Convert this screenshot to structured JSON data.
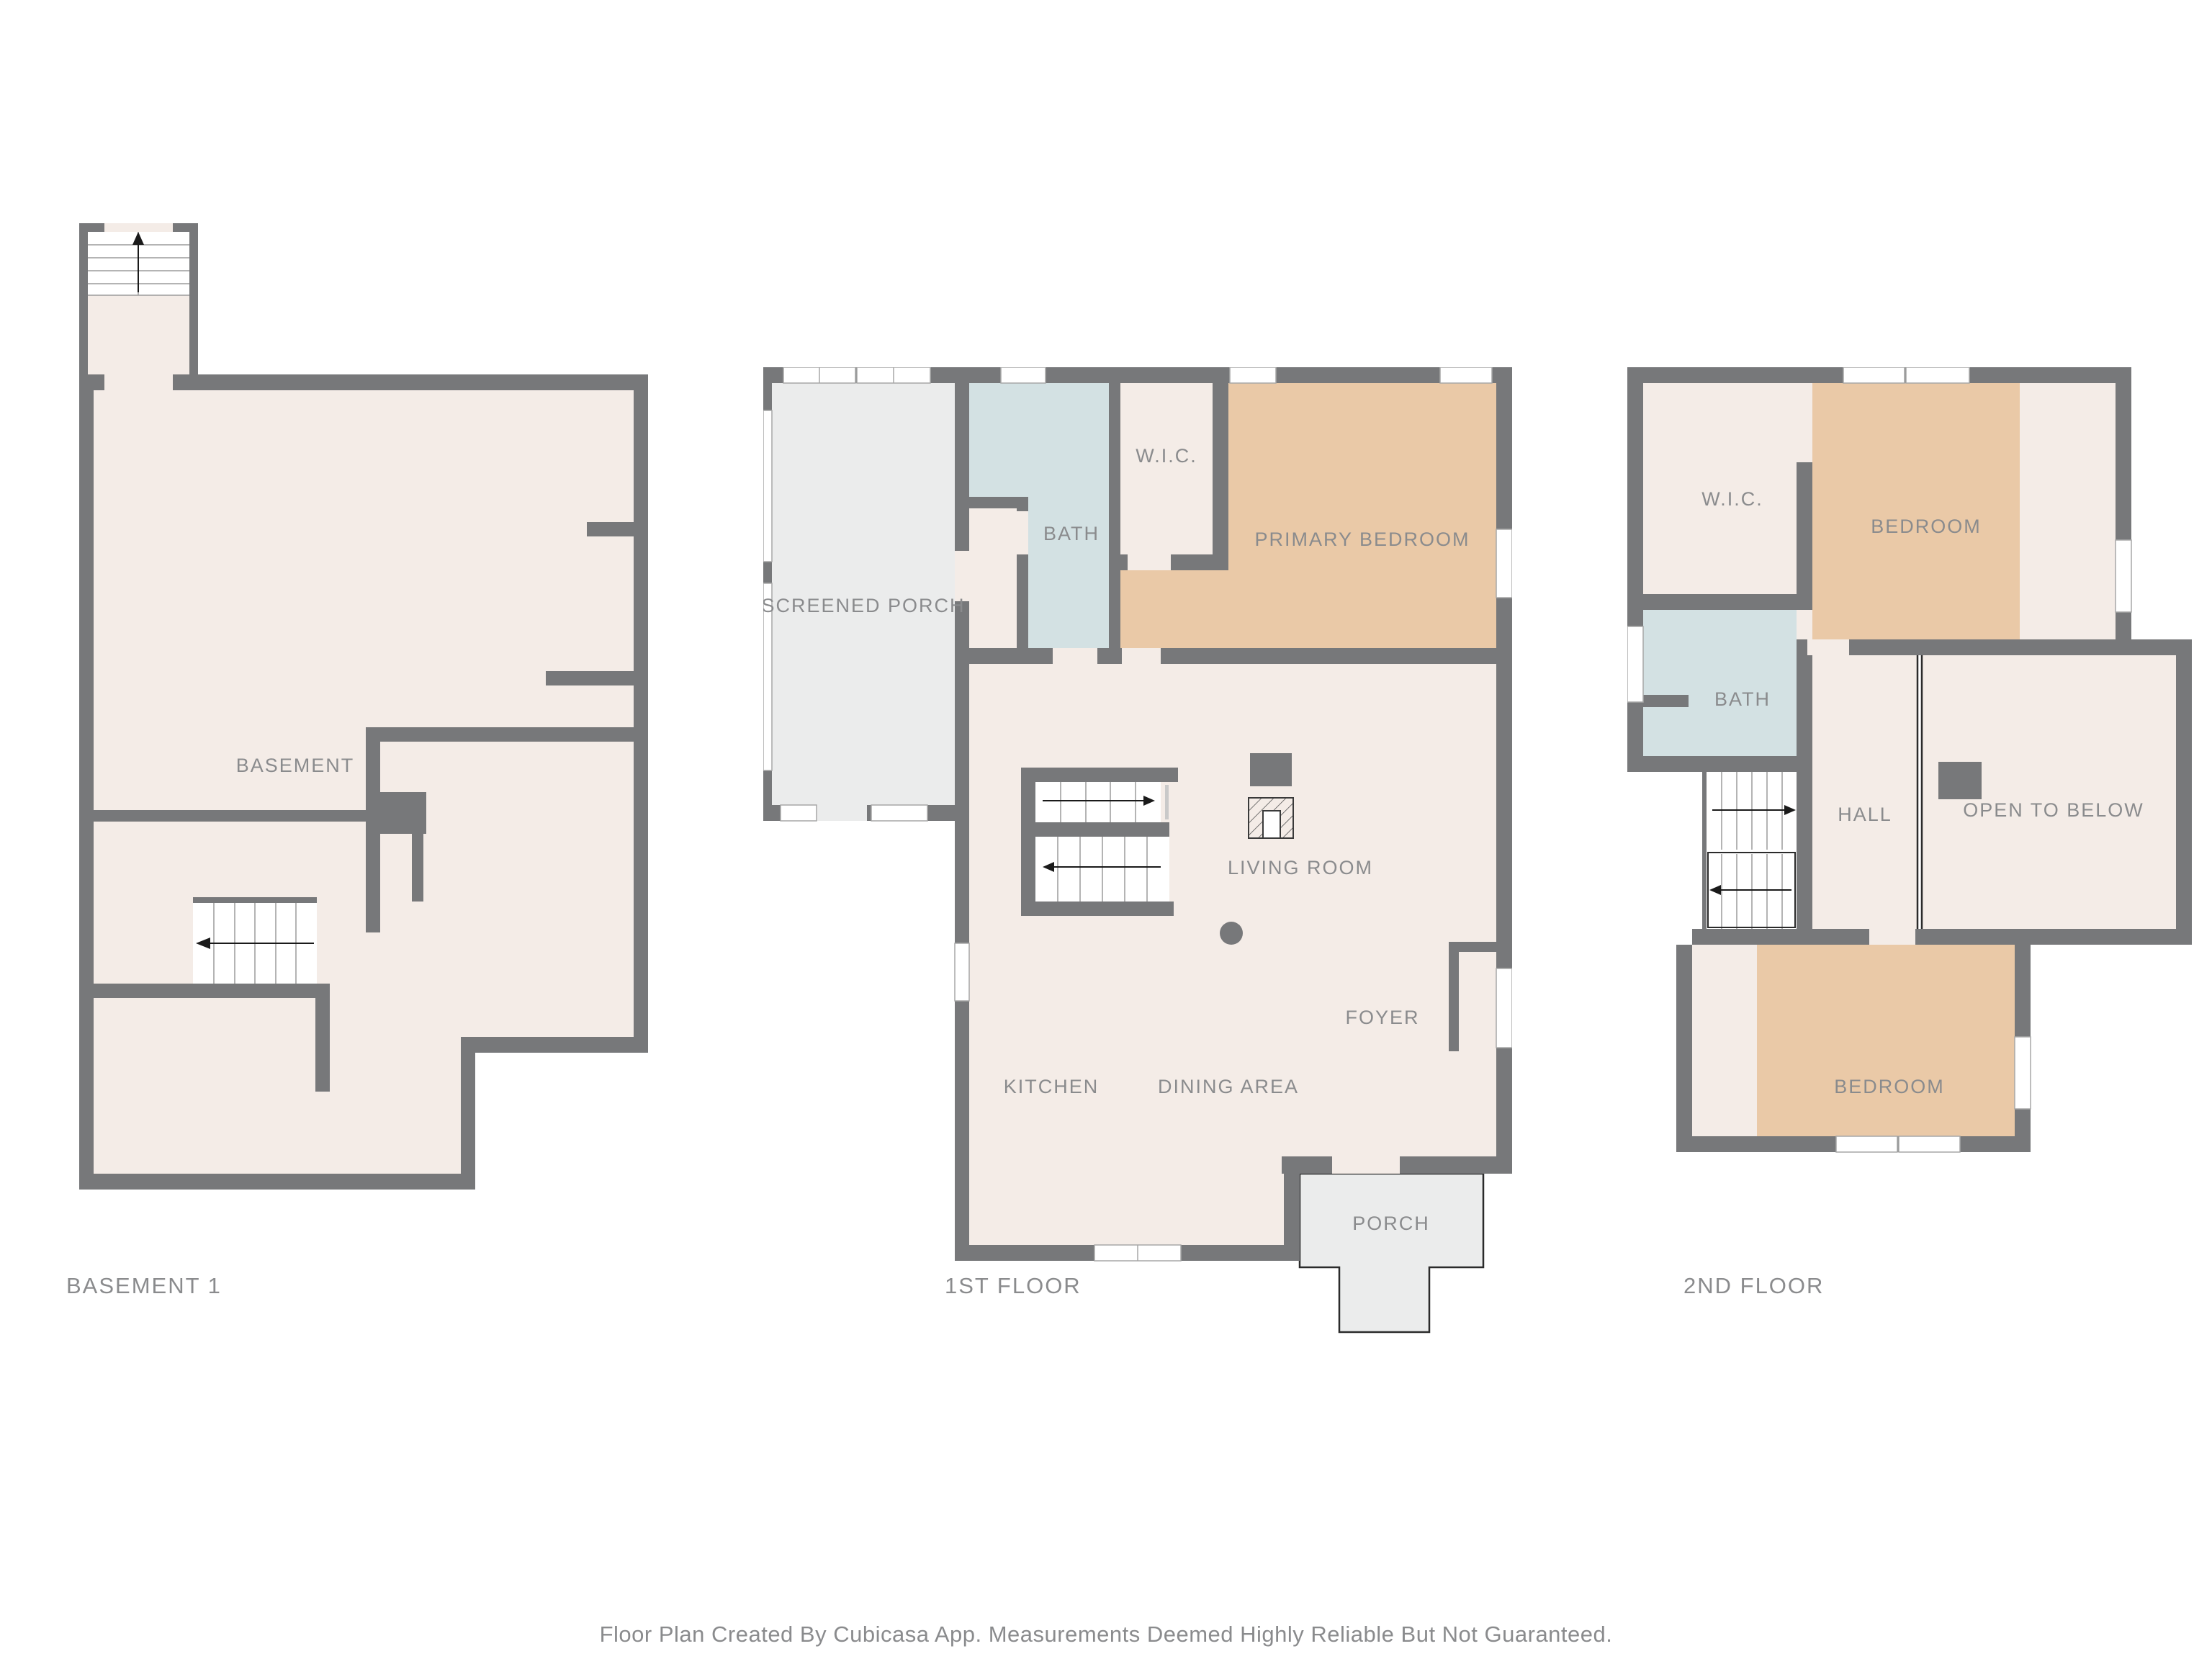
{
  "caption": "Floor Plan Created By Cubicasa App. Measurements Deemed Highly Reliable But Not Guaranteed.",
  "colors": {
    "wall": "#77787a",
    "floor": "#f4ece7",
    "bath": "#d3e1e3",
    "bedroom": "#eac9a7",
    "porch": "#ebecec",
    "label": "#8a8b8d",
    "stair_line": "#9b9b9b",
    "arrow": "#1a1a1a"
  },
  "floors": [
    {
      "id": "basement",
      "title": "BASEMENT 1",
      "rooms": [
        {
          "label": "BASEMENT"
        }
      ]
    },
    {
      "id": "first-floor",
      "title": "1ST FLOOR",
      "rooms": [
        {
          "label": "SCREENED PORCH"
        },
        {
          "label": "BATH"
        },
        {
          "label": "W.I.C."
        },
        {
          "label": "PRIMARY BEDROOM"
        },
        {
          "label": "LIVING ROOM"
        },
        {
          "label": "KITCHEN"
        },
        {
          "label": "DINING AREA"
        },
        {
          "label": "FOYER"
        },
        {
          "label": "PORCH"
        }
      ]
    },
    {
      "id": "second-floor",
      "title": "2ND FLOOR",
      "rooms": [
        {
          "label": "W.I.C."
        },
        {
          "label": "BEDROOM"
        },
        {
          "label": "BATH"
        },
        {
          "label": "HALL"
        },
        {
          "label": "OPEN TO BELOW"
        },
        {
          "label": "BEDROOM"
        }
      ]
    }
  ]
}
